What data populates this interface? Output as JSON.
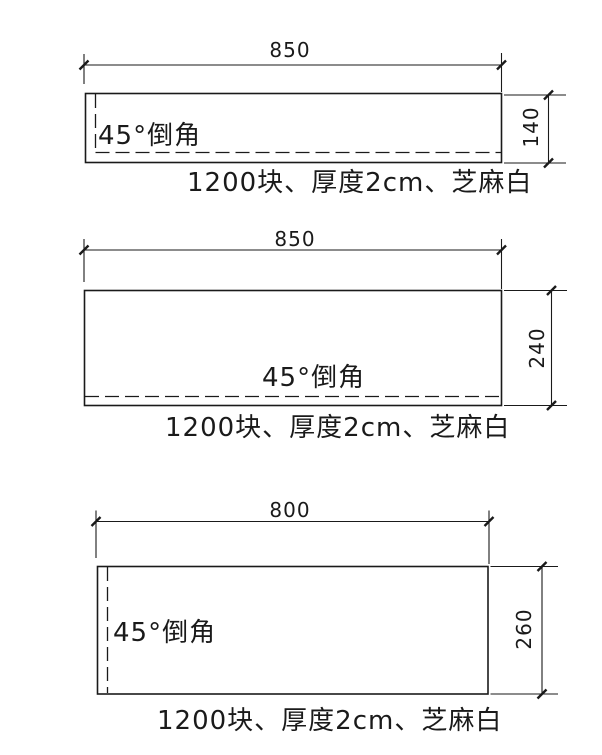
{
  "drawing": {
    "panels": [
      {
        "width_dim": "850",
        "height_dim": "140",
        "chamfer_label": "45°倒角",
        "caption": "1200块、厚度2cm、芝麻白"
      },
      {
        "width_dim": "850",
        "height_dim": "240",
        "chamfer_label": "45°倒角",
        "caption": "1200块、厚度2cm、芝麻白"
      },
      {
        "width_dim": "800",
        "height_dim": "260",
        "chamfer_label": "45°倒角",
        "caption": "1200块、厚度2cm、芝麻白"
      }
    ],
    "colors": {
      "line": "#1a1a1a",
      "text": "#1a1a1a",
      "background": "#ffffff"
    }
  }
}
